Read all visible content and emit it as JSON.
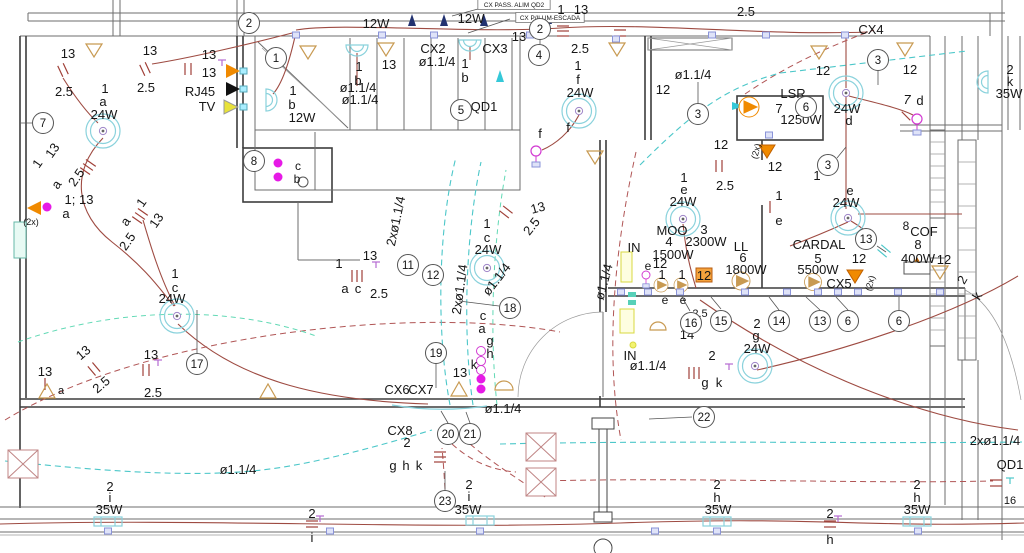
{
  "drawing": {
    "type": "electrical floor plan",
    "boxed_labels": [
      {
        "t": "CX PASS. ALIM QD2",
        "x": 514,
        "y": 7
      },
      {
        "t": "CX P/ILUM-ESCADA",
        "x": 550,
        "y": 20
      }
    ],
    "colors": {
      "text": "#161616",
      "conduit_red": "#9e4b42",
      "dashed_red": "#b05555",
      "dashed_cyan": "#4cc7c9",
      "dashed_mint": "#62d9b5",
      "light_cyan": "#8ad2dc",
      "tan": "#c89a52",
      "orange": "#f08a00",
      "magenta": "#e61ae6",
      "navy": "#223270",
      "yellow": "#e8e23a",
      "outlet_blue": "#8a93d8"
    },
    "icons": [
      "ceiling-light-icon",
      "wall-light-icon",
      "fluorescent-light-icon",
      "pendant-light-icon",
      "switch-ticks-icon",
      "outlet-icon",
      "distribution-triangle-icon",
      "pump-motor-icon",
      "crossed-box-icon",
      "arrow-icon",
      "phone-tv-outlet-icon"
    ],
    "labels": [
      {
        "t": "2.5",
        "x": 746,
        "y": 16
      },
      {
        "t": "CX4",
        "x": 871,
        "y": 34
      },
      {
        "t": "12W",
        "x": 376,
        "y": 28
      },
      {
        "t": "12W",
        "x": 471,
        "y": 23
      },
      {
        "t": "1",
        "x": 561,
        "y": 14
      },
      {
        "t": "13",
        "x": 581,
        "y": 14
      },
      {
        "t": "13",
        "x": 68,
        "y": 58
      },
      {
        "t": "13",
        "x": 150,
        "y": 55
      },
      {
        "t": "2.5",
        "x": 64,
        "y": 96
      },
      {
        "t": "2.5",
        "x": 146,
        "y": 92
      },
      {
        "t": "13",
        "x": 209,
        "y": 59
      },
      {
        "t": "13",
        "x": 209,
        "y": 77
      },
      {
        "t": "RJ45",
        "x": 200,
        "y": 96
      },
      {
        "t": "TV",
        "x": 207,
        "y": 111
      },
      {
        "t": "1",
        "x": 105,
        "y": 93
      },
      {
        "t": "a",
        "x": 103,
        "y": 106
      },
      {
        "t": "24W",
        "x": 104,
        "y": 119
      },
      {
        "t": "1",
        "x": 41,
        "y": 166,
        "r": -55
      },
      {
        "t": "13",
        "x": 56,
        "y": 153,
        "r": -55
      },
      {
        "t": "a",
        "x": 60,
        "y": 187,
        "r": -55
      },
      {
        "t": "2.5",
        "x": 80,
        "y": 180,
        "r": -55
      },
      {
        "t": "1; 13",
        "x": 79,
        "y": 204
      },
      {
        "t": "a",
        "x": 66,
        "y": 218
      },
      {
        "t": "(2x)",
        "x": 31,
        "y": 225,
        "s": 9,
        "c": "#e8920a"
      },
      {
        "t": "1",
        "x": 145,
        "y": 205,
        "r": -55
      },
      {
        "t": "13",
        "x": 160,
        "y": 223,
        "r": -55
      },
      {
        "t": "a",
        "x": 129,
        "y": 224,
        "r": -55
      },
      {
        "t": "2.5",
        "x": 131,
        "y": 244,
        "r": -55
      },
      {
        "t": "1",
        "x": 175,
        "y": 278
      },
      {
        "t": "c",
        "x": 175,
        "y": 292
      },
      {
        "t": "24W",
        "x": 172,
        "y": 303
      },
      {
        "t": "13",
        "x": 45,
        "y": 376
      },
      {
        "t": "13",
        "x": 86,
        "y": 356,
        "r": -40
      },
      {
        "t": "2.5",
        "x": 104,
        "y": 388,
        "r": -40
      },
      {
        "t": "13",
        "x": 151,
        "y": 359
      },
      {
        "t": "2.5",
        "x": 153,
        "y": 397
      },
      {
        "t": "a",
        "x": 61,
        "y": 394,
        "s": 11,
        "c": "#e8920a"
      },
      {
        "t": "1",
        "x": 359,
        "y": 71
      },
      {
        "t": "b",
        "x": 358,
        "y": 85
      },
      {
        "t": "13",
        "x": 389,
        "y": 69
      },
      {
        "t": "CX2",
        "x": 433,
        "y": 53
      },
      {
        "t": "ø1.1/4",
        "x": 437,
        "y": 66
      },
      {
        "t": "CX3",
        "x": 495,
        "y": 53
      },
      {
        "t": "1",
        "x": 465,
        "y": 68
      },
      {
        "t": "b",
        "x": 465,
        "y": 82
      },
      {
        "t": "13",
        "x": 519,
        "y": 41
      },
      {
        "t": "ø1.1/4",
        "x": 358,
        "y": 92
      },
      {
        "t": "ø1.1/4",
        "x": 360,
        "y": 104
      },
      {
        "t": "1",
        "x": 293,
        "y": 95
      },
      {
        "t": "b",
        "x": 292,
        "y": 109
      },
      {
        "t": "12W",
        "x": 302,
        "y": 122
      },
      {
        "t": "QD1",
        "x": 484,
        "y": 111
      },
      {
        "t": "c",
        "x": 298,
        "y": 170,
        "s": 12
      },
      {
        "t": "b",
        "x": 297,
        "y": 183,
        "s": 12
      },
      {
        "t": "2.5",
        "x": 580,
        "y": 53
      },
      {
        "t": "1",
        "x": 578,
        "y": 70
      },
      {
        "t": "f",
        "x": 578,
        "y": 84
      },
      {
        "t": "24W",
        "x": 580,
        "y": 97
      },
      {
        "t": "f",
        "x": 540,
        "y": 138
      },
      {
        "t": "f",
        "x": 568,
        "y": 132
      },
      {
        "t": "2xø1.1/4",
        "x": 400,
        "y": 222,
        "r": -78
      },
      {
        "t": "1",
        "x": 339,
        "y": 268
      },
      {
        "t": "13",
        "x": 370,
        "y": 260
      },
      {
        "t": "a",
        "x": 345,
        "y": 293
      },
      {
        "t": "c",
        "x": 358,
        "y": 293
      },
      {
        "t": "2.5",
        "x": 379,
        "y": 298
      },
      {
        "t": "1",
        "x": 487,
        "y": 228
      },
      {
        "t": "c",
        "x": 487,
        "y": 242
      },
      {
        "t": "24W",
        "x": 488,
        "y": 254
      },
      {
        "t": "ø1.1/4",
        "x": 500,
        "y": 282,
        "r": -52
      },
      {
        "t": "2xø1.1/4",
        "x": 464,
        "y": 290,
        "r": -82
      },
      {
        "t": "13",
        "x": 539,
        "y": 212,
        "r": -15
      },
      {
        "t": "2.5",
        "x": 535,
        "y": 229,
        "r": -52
      },
      {
        "t": "c",
        "x": 483,
        "y": 320
      },
      {
        "t": "a",
        "x": 482,
        "y": 333
      },
      {
        "t": "g",
        "x": 490,
        "y": 345
      },
      {
        "t": "h",
        "x": 490,
        "y": 358
      },
      {
        "t": "k",
        "x": 474,
        "y": 369
      },
      {
        "t": "13",
        "x": 460,
        "y": 377
      },
      {
        "t": "CX6",
        "x": 397,
        "y": 394
      },
      {
        "t": "CX7",
        "x": 421,
        "y": 394
      },
      {
        "t": "ø1.1/4",
        "x": 503,
        "y": 413
      },
      {
        "t": "CX8",
        "x": 400,
        "y": 435
      },
      {
        "t": "2",
        "x": 407,
        "y": 447
      },
      {
        "t": "g",
        "x": 393,
        "y": 470
      },
      {
        "t": "h",
        "x": 406,
        "y": 470
      },
      {
        "t": "k",
        "x": 419,
        "y": 470
      },
      {
        "t": "ø1.1/4",
        "x": 238,
        "y": 474
      },
      {
        "t": "2",
        "x": 110,
        "y": 491
      },
      {
        "t": "i",
        "x": 110,
        "y": 502
      },
      {
        "t": "35W",
        "x": 109,
        "y": 514
      },
      {
        "t": "2",
        "x": 469,
        "y": 489
      },
      {
        "t": "i",
        "x": 469,
        "y": 501
      },
      {
        "t": "35W",
        "x": 468,
        "y": 514
      },
      {
        "t": "2",
        "x": 312,
        "y": 518
      },
      {
        "t": "i",
        "x": 312,
        "y": 542
      },
      {
        "t": "ø1.1/4",
        "x": 693,
        "y": 79
      },
      {
        "t": "12",
        "x": 663,
        "y": 94
      },
      {
        "t": "12",
        "x": 721,
        "y": 149
      },
      {
        "t": "2.5",
        "x": 725,
        "y": 190
      },
      {
        "t": "LSR",
        "x": 793,
        "y": 98
      },
      {
        "t": "7",
        "x": 779,
        "y": 113
      },
      {
        "t": "1250W",
        "x": 801,
        "y": 124
      },
      {
        "t": "(2x)",
        "x": 759,
        "y": 152,
        "s": 9,
        "c": "#e8920a",
        "r": -75
      },
      {
        "t": "12",
        "x": 775,
        "y": 171
      },
      {
        "t": "1",
        "x": 684,
        "y": 182
      },
      {
        "t": "e",
        "x": 684,
        "y": 194
      },
      {
        "t": "24W",
        "x": 683,
        "y": 206
      },
      {
        "t": "12",
        "x": 823,
        "y": 75
      },
      {
        "t": "12",
        "x": 910,
        "y": 74
      },
      {
        "t": "24W",
        "x": 847,
        "y": 113
      },
      {
        "t": "d",
        "x": 849,
        "y": 125
      },
      {
        "t": "7",
        "x": 907,
        "y": 104,
        "i": 1
      },
      {
        "t": "d",
        "x": 920,
        "y": 105
      },
      {
        "t": "2",
        "x": 1010,
        "y": 74
      },
      {
        "t": "k",
        "x": 1010,
        "y": 86
      },
      {
        "t": "35W",
        "x": 1009,
        "y": 98
      },
      {
        "t": "MOO",
        "x": 672,
        "y": 235
      },
      {
        "t": "3",
        "x": 704,
        "y": 234
      },
      {
        "t": "4",
        "x": 669,
        "y": 246
      },
      {
        "t": "2300W",
        "x": 706,
        "y": 246
      },
      {
        "t": "1500W",
        "x": 673,
        "y": 259
      },
      {
        "t": "IN",
        "x": 634,
        "y": 252
      },
      {
        "t": "e",
        "x": 648,
        "y": 270,
        "s": 12
      },
      {
        "t": "12",
        "x": 660,
        "y": 268
      },
      {
        "t": "1",
        "x": 662,
        "y": 279
      },
      {
        "t": "1",
        "x": 682,
        "y": 279
      },
      {
        "t": "12",
        "x": 704,
        "y": 280
      },
      {
        "t": "LL",
        "x": 741,
        "y": 251
      },
      {
        "t": "6",
        "x": 743,
        "y": 262
      },
      {
        "t": "1800W",
        "x": 746,
        "y": 274
      },
      {
        "t": "ø1.1/4",
        "x": 608,
        "y": 283,
        "r": -75
      },
      {
        "t": "e",
        "x": 665,
        "y": 304,
        "s": 12
      },
      {
        "t": "e",
        "x": 683,
        "y": 304,
        "s": 12
      },
      {
        "t": "2.5",
        "x": 700,
        "y": 317,
        "s": 11
      },
      {
        "t": "14",
        "x": 687,
        "y": 339
      },
      {
        "t": "2",
        "x": 757,
        "y": 328
      },
      {
        "t": "g",
        "x": 756,
        "y": 340
      },
      {
        "t": "24W",
        "x": 757,
        "y": 353
      },
      {
        "t": "2",
        "x": 712,
        "y": 360
      },
      {
        "t": "g",
        "x": 705,
        "y": 387
      },
      {
        "t": "k",
        "x": 719,
        "y": 387
      },
      {
        "t": "IN",
        "x": 630,
        "y": 360
      },
      {
        "t": "ø1.1/4",
        "x": 648,
        "y": 370
      },
      {
        "t": "1",
        "x": 817,
        "y": 180
      },
      {
        "t": "e",
        "x": 850,
        "y": 195
      },
      {
        "t": "24W",
        "x": 846,
        "y": 207
      },
      {
        "t": "1",
        "x": 779,
        "y": 200
      },
      {
        "t": "e",
        "x": 779,
        "y": 225
      },
      {
        "t": "CARDAL",
        "x": 819,
        "y": 249
      },
      {
        "t": "5",
        "x": 818,
        "y": 263
      },
      {
        "t": "5500W",
        "x": 818,
        "y": 274
      },
      {
        "t": "12",
        "x": 859,
        "y": 263
      },
      {
        "t": "CX5",
        "x": 839,
        "y": 288
      },
      {
        "t": "(2x)",
        "x": 873,
        "y": 284,
        "s": 9,
        "c": "#e8920a",
        "r": -75
      },
      {
        "t": "8",
        "x": 906,
        "y": 230,
        "s": 12
      },
      {
        "t": "COF",
        "x": 924,
        "y": 236
      },
      {
        "t": "8",
        "x": 918,
        "y": 249
      },
      {
        "t": "400W",
        "x": 918,
        "y": 263
      },
      {
        "t": "12",
        "x": 944,
        "y": 264
      },
      {
        "t": "2",
        "x": 966,
        "y": 282,
        "r": -60
      },
      {
        "t": "k",
        "x": 981,
        "y": 298,
        "r": -60
      },
      {
        "t": "2",
        "x": 717,
        "y": 489
      },
      {
        "t": "h",
        "x": 717,
        "y": 502
      },
      {
        "t": "35W",
        "x": 718,
        "y": 514
      },
      {
        "t": "2",
        "x": 830,
        "y": 518
      },
      {
        "t": "h",
        "x": 830,
        "y": 544
      },
      {
        "t": "2",
        "x": 917,
        "y": 489
      },
      {
        "t": "h",
        "x": 917,
        "y": 502
      },
      {
        "t": "35W",
        "x": 917,
        "y": 514
      },
      {
        "t": "2xø1.1/4",
        "x": 995,
        "y": 445
      },
      {
        "t": "QD1",
        "x": 1010,
        "y": 469
      },
      {
        "t": "16",
        "x": 1010,
        "y": 504,
        "s": 11
      }
    ],
    "circled_numbers": [
      {
        "n": "2",
        "x": 249,
        "y": 23
      },
      {
        "n": "1",
        "x": 276,
        "y": 58
      },
      {
        "n": "2",
        "x": 540,
        "y": 29
      },
      {
        "n": "4",
        "x": 539,
        "y": 55
      },
      {
        "n": "5",
        "x": 461,
        "y": 110
      },
      {
        "n": "3",
        "x": 698,
        "y": 114
      },
      {
        "n": "3",
        "x": 878,
        "y": 60
      },
      {
        "n": "6",
        "x": 806,
        "y": 107
      },
      {
        "n": "7",
        "x": 43,
        "y": 123
      },
      {
        "n": "8",
        "x": 254,
        "y": 161
      },
      {
        "n": "3",
        "x": 828,
        "y": 165
      },
      {
        "n": "11",
        "x": 408,
        "y": 265
      },
      {
        "n": "12",
        "x": 433,
        "y": 275
      },
      {
        "n": "13",
        "x": 866,
        "y": 239
      },
      {
        "n": "17",
        "x": 197,
        "y": 364
      },
      {
        "n": "18",
        "x": 510,
        "y": 308
      },
      {
        "n": "19",
        "x": 436,
        "y": 353
      },
      {
        "n": "20",
        "x": 448,
        "y": 434
      },
      {
        "n": "21",
        "x": 470,
        "y": 434
      },
      {
        "n": "22",
        "x": 704,
        "y": 417
      },
      {
        "n": "23",
        "x": 445,
        "y": 501
      },
      {
        "n": "16",
        "x": 691,
        "y": 323
      },
      {
        "n": "15",
        "x": 721,
        "y": 321
      },
      {
        "n": "14",
        "x": 779,
        "y": 321
      },
      {
        "n": "13",
        "x": 820,
        "y": 321
      },
      {
        "n": "6",
        "x": 848,
        "y": 321
      },
      {
        "n": "6",
        "x": 899,
        "y": 321
      }
    ]
  }
}
